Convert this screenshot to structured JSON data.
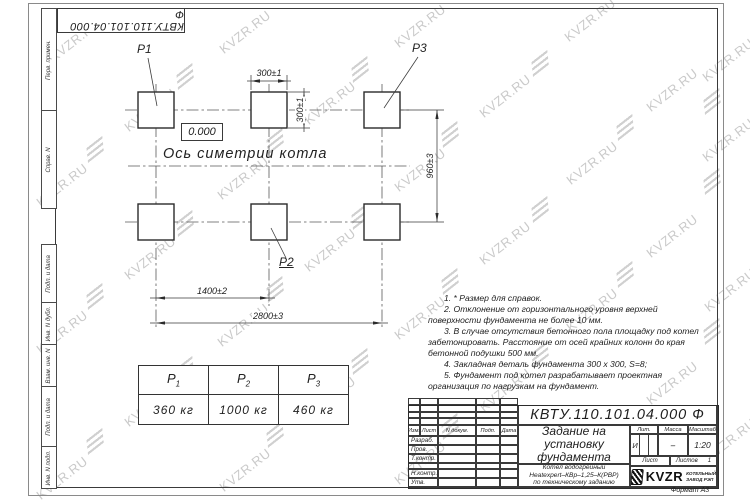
{
  "sheet": {
    "stamp_doc_number": "КВТУ.110.101.04.000  Ф",
    "format_label": "Формат А3"
  },
  "watermark": {
    "text": "KVZR.RU"
  },
  "margin_labels": {
    "top": [
      "Перв. примен.",
      "Справ. N"
    ],
    "bottom": [
      "Подп. и дата",
      "Инв. N дубл.",
      "Взам. инв. N",
      "Подп. и дата",
      "Инв. N подл."
    ]
  },
  "plan": {
    "pads": {
      "p1": "P1",
      "p2": "P2",
      "p3": "P3"
    },
    "level_mark": "0.000",
    "axis_label": "Ось симетрии котла",
    "dimensions": {
      "pad_width": "300±1",
      "pad_height": "300±1",
      "row_spacing": "960±3",
      "col_spacing": "1400±2",
      "total_span": "2800±3"
    }
  },
  "load_table": {
    "columns": [
      {
        "sym": "P",
        "sub": "1"
      },
      {
        "sym": "P",
        "sub": "2"
      },
      {
        "sym": "P",
        "sub": "3"
      }
    ],
    "values": [
      "360  кг",
      "1000  кг",
      "460  кг"
    ]
  },
  "notes": [
    "1.  * Размер для справок.",
    "2.  Отклонение от горизонтального уровня верхней поверхности фундамента не более 10 мм.",
    "3.  В случае отсутствия бетонного пола площадку под котел забетонировать. Расстояние от осей крайних колонн до края бетонной подушки 500 мм.",
    "4.  Закладная деталь фундамента  300 х 300,  S=8;",
    "5.  Фундамент под котел разрабатывает проектная организация по нагрузкам на фундамент."
  ],
  "title_block": {
    "doc_number": "КВТУ.110.101.04.000  Ф",
    "title": "Задание на установку фундамента",
    "product_lines": [
      "Котел водогрейный",
      "Heatexpert–КВр–1,25–К(РВР)",
      "по техническому заданию"
    ],
    "rev_headers": [
      "Изм.",
      "Лист",
      "N докум.",
      "Подп.",
      "Дата"
    ],
    "staff_rows": [
      "Разраб.",
      "Пров.",
      "Т.контр.",
      "",
      "Н.контр.",
      "Утв."
    ],
    "props_headers": [
      "Лит.",
      "Масса",
      "Масштаб"
    ],
    "lit_value": "И",
    "mass_value": "–",
    "scale_value": "1:20",
    "sheet_label": "Лист",
    "sheets_label": "Листов",
    "sheets_value": "1",
    "logo_text": "KVZR",
    "logo_caption_lines": [
      "КОТЕЛЬНЫЙ",
      "ЗАВОД РЭП"
    ]
  }
}
